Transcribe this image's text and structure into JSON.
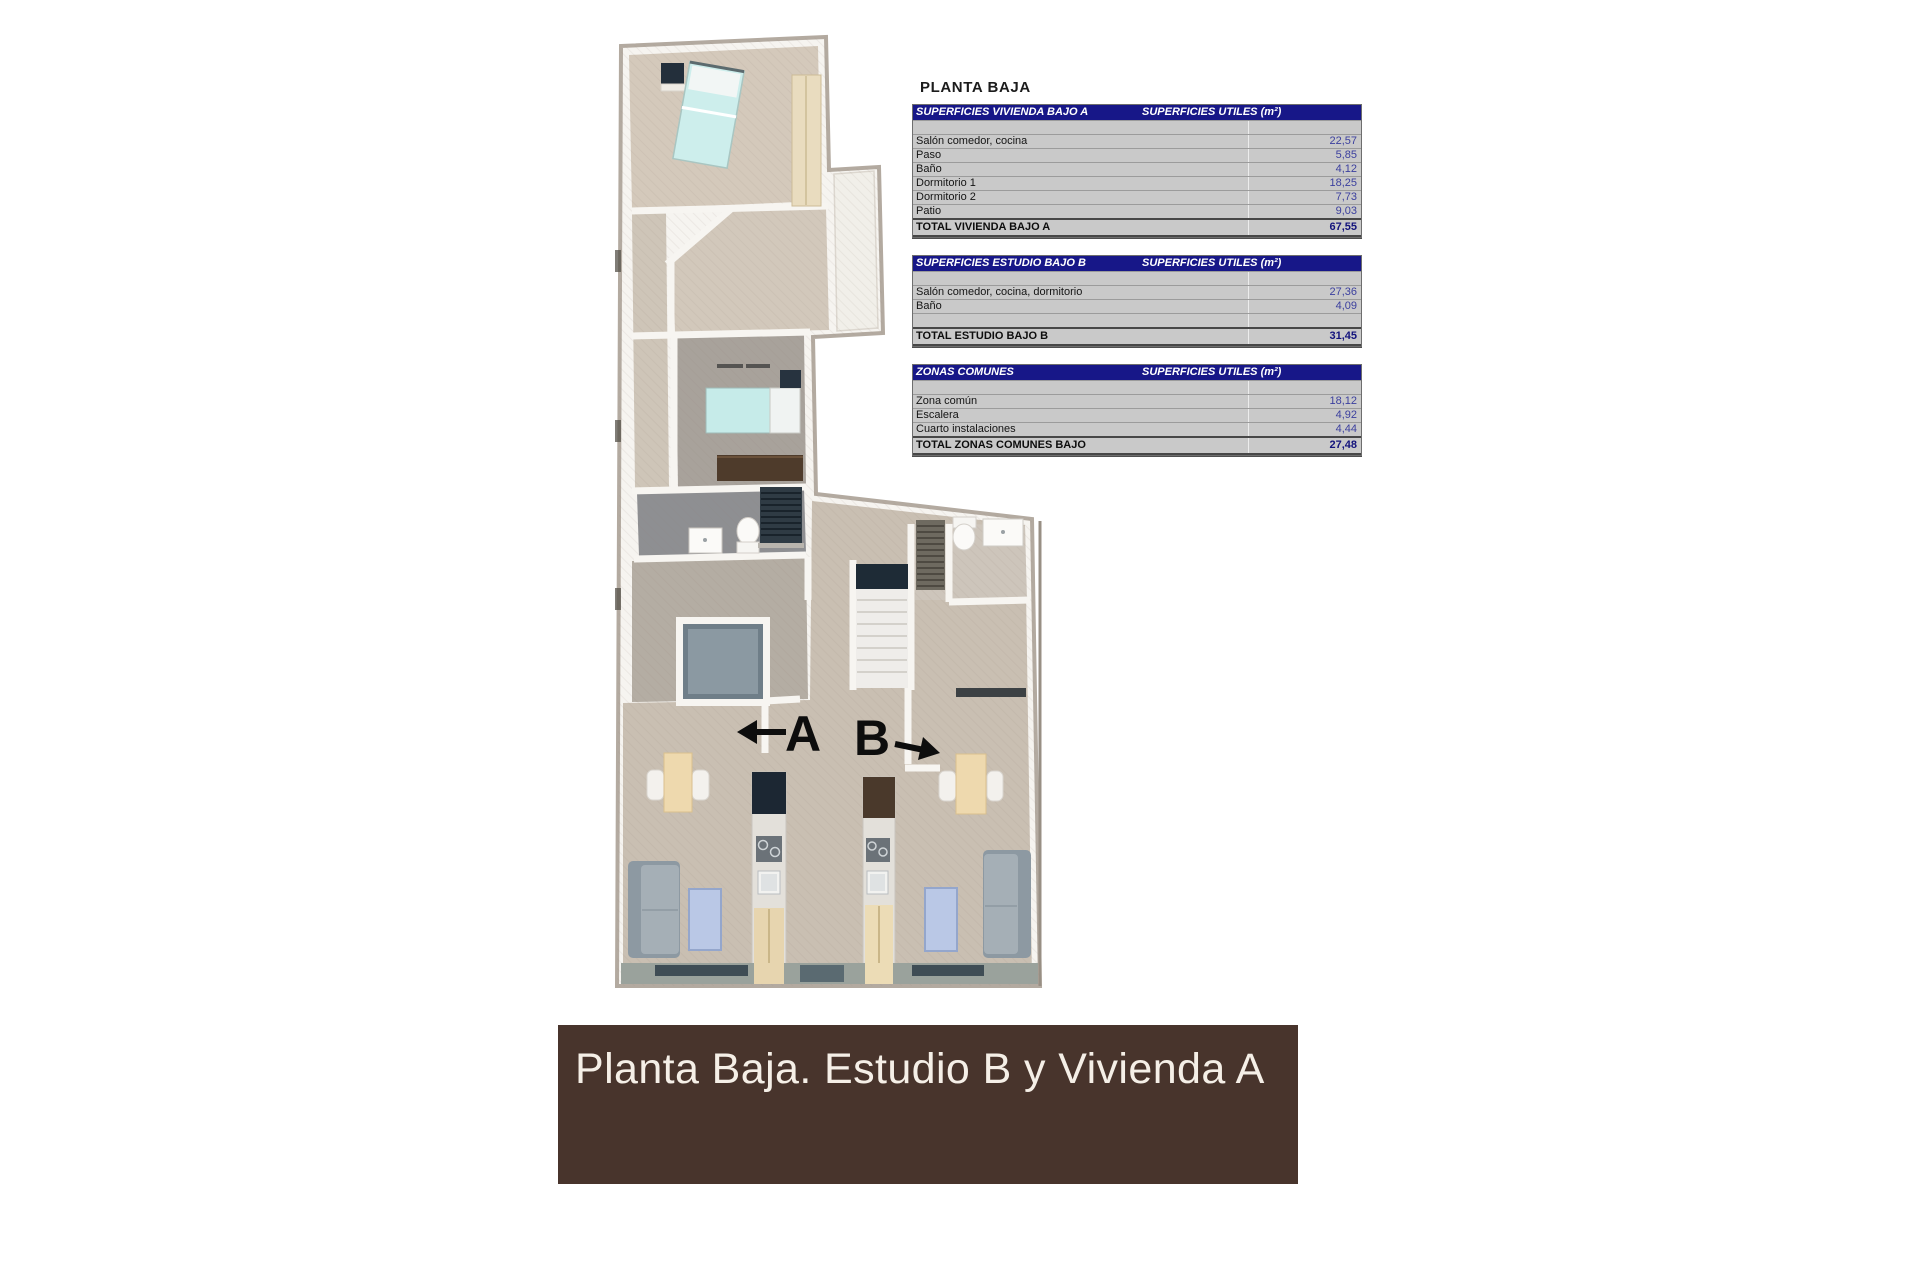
{
  "heading": "PLANTA BAJA",
  "tables": [
    {
      "title": "SUPERFICIES VIVIENDA BAJO A",
      "units_header": "SUPERFICIES UTILES  (m²)",
      "rows": [
        {
          "label": "",
          "value": ""
        },
        {
          "label": "Salón comedor, cocina",
          "value": "22,57"
        },
        {
          "label": "Paso",
          "value": "5,85"
        },
        {
          "label": "Baño",
          "value": "4,12"
        },
        {
          "label": "Dormitorio 1",
          "value": "18,25"
        },
        {
          "label": "Dormitorio 2",
          "value": "7,73"
        },
        {
          "label": "Patio",
          "value": "9,03"
        }
      ],
      "total_label": "TOTAL VIVIENDA BAJO A",
      "total_value": "67,55"
    },
    {
      "title": "SUPERFICIES ESTUDIO BAJO B",
      "units_header": "SUPERFICIES UTILES  (m²)",
      "rows": [
        {
          "label": "",
          "value": ""
        },
        {
          "label": "Salón comedor, cocina, dormitorio",
          "value": "27,36"
        },
        {
          "label": "Baño",
          "value": "4,09"
        },
        {
          "label": "",
          "value": ""
        }
      ],
      "total_label": "TOTAL ESTUDIO BAJO B",
      "total_value": "31,45"
    },
    {
      "title": "ZONAS COMUNES",
      "units_header": "SUPERFICIES UTILES  (m²)",
      "rows": [
        {
          "label": "",
          "value": ""
        },
        {
          "label": "Zona común",
          "value": "18,12"
        },
        {
          "label": "Escalera",
          "value": "4,92"
        },
        {
          "label": "Cuarto instalaciones",
          "value": "4,44"
        }
      ],
      "total_label": "TOTAL ZONAS COMUNES BAJO",
      "total_value": "27,48"
    }
  ],
  "floorplan": {
    "unit_a_label": "A",
    "unit_b_label": "B"
  },
  "banner": {
    "text": "Planta Baja. Estudio B y Vivienda A",
    "bg_color": "#48342c",
    "text_color": "#f5efe7"
  },
  "colors": {
    "table_header_bg": "#171788",
    "table_row_bg": "#c9c9c9",
    "table_value_text": "#3b3f9e",
    "floor_beige": "#c9bfb2",
    "bed_teal": "#cdeeec"
  }
}
